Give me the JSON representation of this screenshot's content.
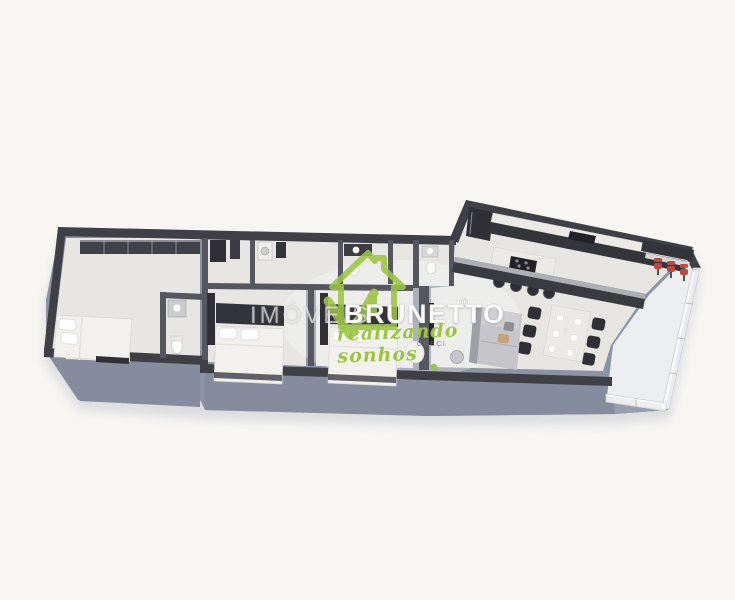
{
  "image": {
    "type": "3d-floor-plan-render",
    "description": "isometric 3D render of an apartment floor plan on a plain light background"
  },
  "watermark": {
    "prefix": "IMÓVEIS",
    "brand": "BRUNETTO",
    "registered": "®",
    "tagline": "realizando sonhos",
    "subtext": "CRECI",
    "logo": "green-house-with-checkmark"
  },
  "colors": {
    "background": "#f7f6f3",
    "slab_side": "#8b93a4",
    "slab_face": "#848c9e",
    "wall_top": "#3f3f46",
    "wall_face": "#56565e",
    "floor_main": "#e7e6e3",
    "floor_light": "#eceeef",
    "dark_furniture": "#2f2f35",
    "counter_marble": "#eceae6",
    "bed_white": "#f2f1ee",
    "sofa_gray": "#c6c6ca",
    "accent_red": "#bb4a42",
    "brand_green": "#9bc53f"
  },
  "floor_plan": {
    "rooms": [
      "master-suite",
      "ensuite-bathroom",
      "bedroom-2",
      "bedroom-3",
      "hall-bathroom-laundry",
      "second-bathroom",
      "kitchen",
      "dining-area",
      "living-area",
      "gourmet-balcony"
    ],
    "furniture": [
      "master-double-bed",
      "wardrobe-ribbon-windows",
      "vanity-sink",
      "toilet",
      "bedroom2-bed-with-headboard",
      "bedroom3-bed-with-headboard",
      "refrigerator",
      "kitchen-back-counter",
      "kitchen-island-with-cooktop",
      "bar-stools-x4",
      "peninsula-bar-counter",
      "dining-table-with-6-chairs",
      "l-shaped-sofa",
      "side-table",
      "accent-armchair",
      "tv-panel",
      "balcony-bar-with-3-red-stools",
      "glass-railing",
      "plant"
    ]
  }
}
